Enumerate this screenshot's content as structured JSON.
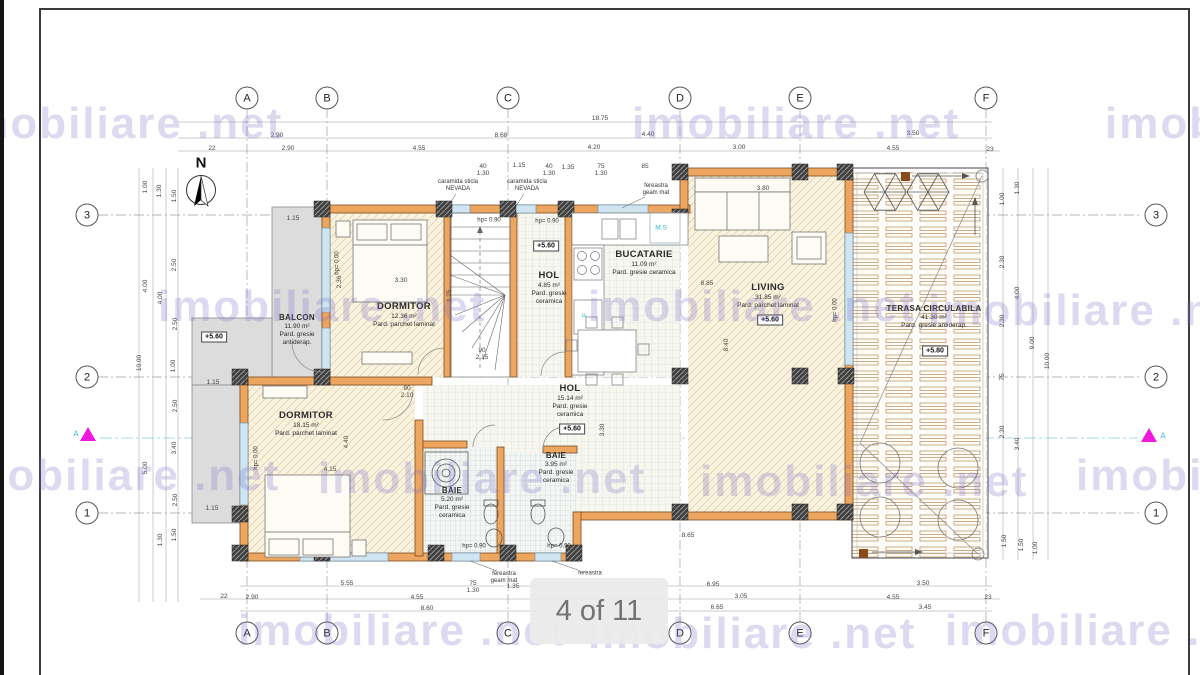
{
  "viewer": {
    "page_indicator": "4 of 11"
  },
  "watermark": {
    "text": "imobiliare .net"
  },
  "plan": {
    "compass_label": "N",
    "section_label": "A",
    "grid_cols": [
      "A",
      "B",
      "C",
      "D",
      "E",
      "F"
    ],
    "grid_rows": [
      "3",
      "2",
      "1"
    ],
    "rooms": [
      {
        "name": "BALCON",
        "area": "11.90 m²",
        "floor": "Pard. gresie antiderap."
      },
      {
        "name": "DORMITOR",
        "area": "12.36 m²",
        "floor": "Pard. parchet laminat"
      },
      {
        "name": "HOL",
        "area": "4.85 m²",
        "floor": "Pard. gresie ceramica"
      },
      {
        "name": "BUCATARIE",
        "area": "11.09 m²",
        "floor": "Pard. gresie ceramica"
      },
      {
        "name": "LIVING",
        "area": "31.85 m²",
        "floor": "Pard. parchet laminat"
      },
      {
        "name": "TERASA CIRCULABILA",
        "area": "41.30 m²",
        "floor": "Pard. gresie antiderap."
      },
      {
        "name": "DORMITOR",
        "area": "18.15 m²",
        "floor": "Pard. parchet laminat"
      },
      {
        "name": "HOL",
        "area": "15.14 m²",
        "floor": "Pard. gresie ceramica"
      },
      {
        "name": "BAIE",
        "area": "5.20 m²",
        "floor": "Pard. gresie ceramica"
      },
      {
        "name": "BAIE",
        "area": "3.95 m²",
        "floor": "Pard. gresie ceramica"
      }
    ],
    "elevations": {
      "balcon": "+5.60",
      "hol_sus": "+5.60",
      "hol_jos": "+5.60",
      "living": "+5.60",
      "terasa": "+5.80"
    },
    "annotations": {
      "nevada": "caramida sticla NEVADA",
      "fereastra_geam_mat": "fereastra geam mat",
      "fereastra": "fereastra",
      "hp_090": "hp= 0.90",
      "hp_000": "hp= 0.00",
      "ms": "M.S",
      "f": "F"
    },
    "dims": {
      "top": [
        "18.75",
        "2.90",
        "8.68",
        "4.40",
        "3.50",
        "22",
        "2.90",
        "4.55",
        "4.20",
        "3.00",
        "4.55",
        "23"
      ],
      "top_small": [
        "40",
        "1.15",
        "40",
        "1.30",
        "1.30",
        "75",
        "1.30",
        "85",
        "1.35"
      ],
      "bottom": [
        "5.55",
        "75",
        "1.30",
        "1.35",
        "6.95",
        "3.50",
        "22",
        "2.90",
        "4.55",
        "3.05",
        "4.55",
        "23",
        "8.60",
        "6.65",
        "3.45",
        "8.65"
      ],
      "left": [
        "1.00",
        "1.30",
        "1.50",
        "2.50",
        "4.00",
        "4.00",
        "2.50",
        "10.00",
        "1.00",
        "2.50",
        "3.40",
        "5.00",
        "2.50",
        "1.50",
        "1.30"
      ],
      "right": [
        "1.30",
        "1.00",
        "2.30",
        "4.00",
        "2.30",
        "9.00",
        "10.00",
        "75",
        "2.30",
        "3.40",
        "1.50",
        "1.50",
        "1.00"
      ],
      "interior": [
        "3.30",
        "2.36",
        "3.25",
        "3.80",
        "8.85",
        "8.40",
        "3.30",
        "4.40",
        "4.15",
        "90",
        "2.10",
        "90",
        "2.15",
        "1.15",
        "1.15",
        "1.15"
      ]
    }
  }
}
